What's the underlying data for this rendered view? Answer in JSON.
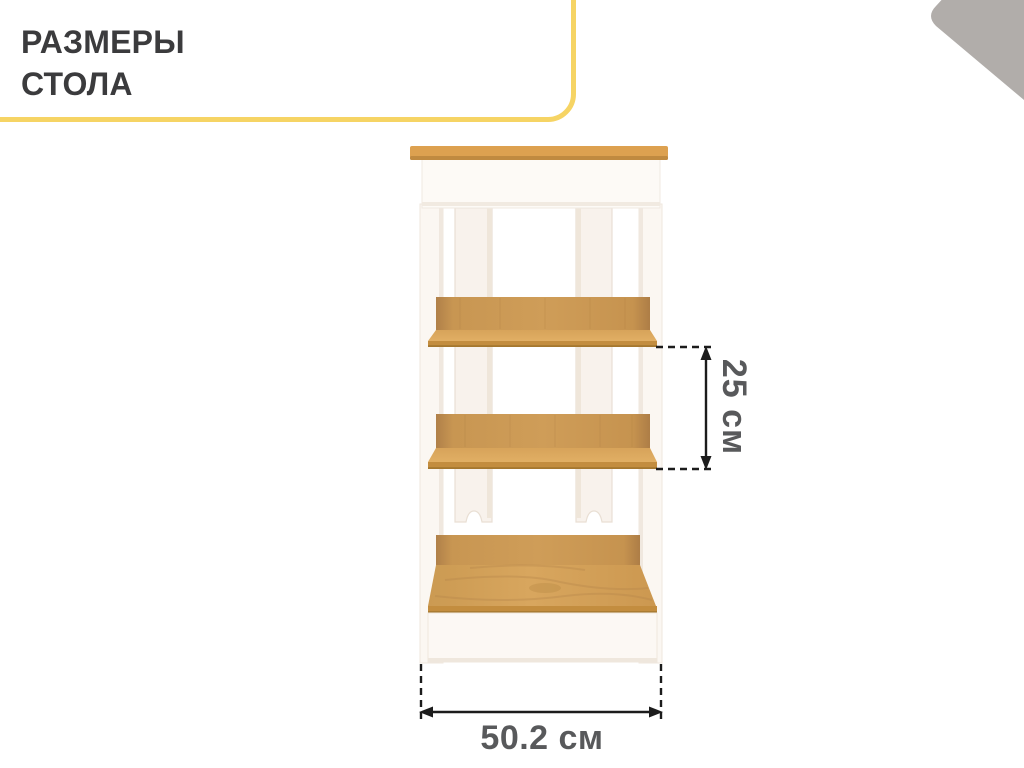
{
  "badge": {
    "line1": "РАЗМЕРЫ",
    "line2": "СТОЛА"
  },
  "dimensions": {
    "shelf_spacing_label": "25 см",
    "width_label": "50.2 см"
  },
  "colors": {
    "badge_border": "#f6d464",
    "corner_triangle": "#b1adaa",
    "wood_top": "#dda150",
    "wood_shelf": "#d6a45c",
    "wood_edge": "#c38d3f",
    "furniture_white": "#fbf7f2",
    "dimension_text": "#58595b",
    "dimension_line": "#1c1c1c"
  }
}
